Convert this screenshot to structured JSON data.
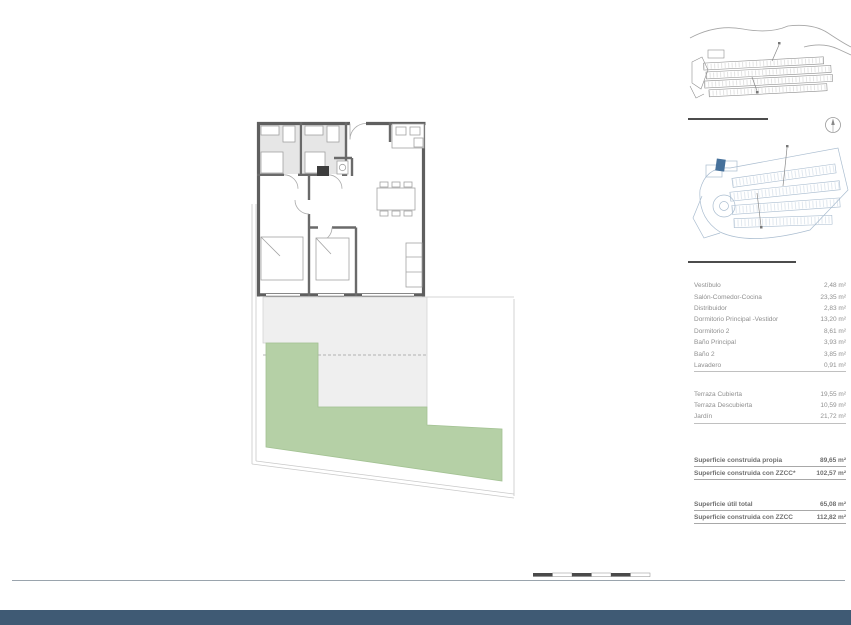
{
  "page": {
    "title": "Vivienda 116 - Bloque B16 - Planta PB0 - Puerta B",
    "disclaimer": "La información aquí contenida puede ser modificada durante el transcurso de la ejecución de la obra por exigencias técnicas y jurídicas, sin que ello implique menoscabo en el nivel global de calidades. El mobiliario, incluido el de cocina, se refleja a efectos meramente decorativos, sin que se incluya en la oferta. Los peldaños de acceso a la vivienda y solados o patios, puede alterarse en función de la rasante de las calles y corresponde a la D.F. fijar el criterio."
  },
  "plan": {
    "bano_principal_l1": "Baño",
    "bano_principal_l2": "Principal",
    "bano2": "Baño 2",
    "vestibulo": "Vestíbulo",
    "distribuidor": "Distribuidor",
    "dorm_ppal_l1": "Dormitorio",
    "dorm_ppal_l2": "Principal-Vestidor",
    "dorm2": "Dormitorio 2",
    "salon": "Salón-Comedor-Cocina",
    "terraza_cubierta_l1": "Terraza",
    "terraza_cubierta_l2": "Cubierta",
    "terraza_descubierta_l1": "Terraza",
    "terraza_descubierta_l2": "Descubierta",
    "jardin": "Jardín"
  },
  "emplazamiento": {
    "heading": "EMPLAZAMIENTO",
    "map1_fase1": "FASE 1",
    "map1_fase2": "FASE 2",
    "map2_fase1": "FASE 1",
    "map2_fase2": "FASE 2",
    "north": "N"
  },
  "superficies": {
    "heading": "CUADRO DE SUPERFICIES",
    "interior_rows": [
      {
        "label": "Vestíbulo",
        "value": "2,48 m²"
      },
      {
        "label": "Salón-Comedor-Cocina",
        "value": "23,35 m²"
      },
      {
        "label": "Distribuidor",
        "value": "2,83 m²"
      },
      {
        "label": "Dormitorio Principal -Vestidor",
        "value": "13,20 m²"
      },
      {
        "label": "Dormitorio 2",
        "value": "8,61 m²"
      },
      {
        "label": "Baño Principal",
        "value": "3,93 m²"
      },
      {
        "label": "Baño 2",
        "value": "3,85 m²"
      },
      {
        "label": "Lavadero",
        "value": "0,91 m²"
      }
    ],
    "interior_total": {
      "label": "Total Sup. Útil Interior",
      "value": "59,18 m²"
    },
    "exterior_rows": [
      {
        "label": "Terraza Cubierta",
        "value": "19,55 m²"
      },
      {
        "label": "Terraza Descubierta",
        "value": "10,59 m²"
      },
      {
        "label": "Jardín",
        "value": "21,72 m²"
      }
    ],
    "exterior_total": {
      "label": "Total Sup. Útil Exterior",
      "value": "51,86 m²"
    },
    "construida_rows": [
      {
        "label": "Superficie construida propia",
        "value": "89,65 m²"
      },
      {
        "label": "Superficie construida con ZZCC*",
        "value": "102,57 m²"
      }
    ],
    "decreto_heading": "Según Decreto BOJA 218/2005",
    "decreto_rows": [
      {
        "label": "Superficie útil total",
        "value": "65,08 m²"
      },
      {
        "label": "Superficie construida con ZZCC",
        "value": "112,82 m²"
      }
    ],
    "footnote": "*No se incluyen terrazas"
  },
  "scalebar": {
    "labels": [
      "0",
      "1",
      "2",
      "3",
      "4",
      "5m"
    ]
  },
  "colors": {
    "accent_bar": "#3f5a74",
    "garden_green": "#b5d0a6",
    "terrace_gray": "#efefef",
    "highlight_block": "#46719b",
    "title_text": "#5f7e95"
  }
}
